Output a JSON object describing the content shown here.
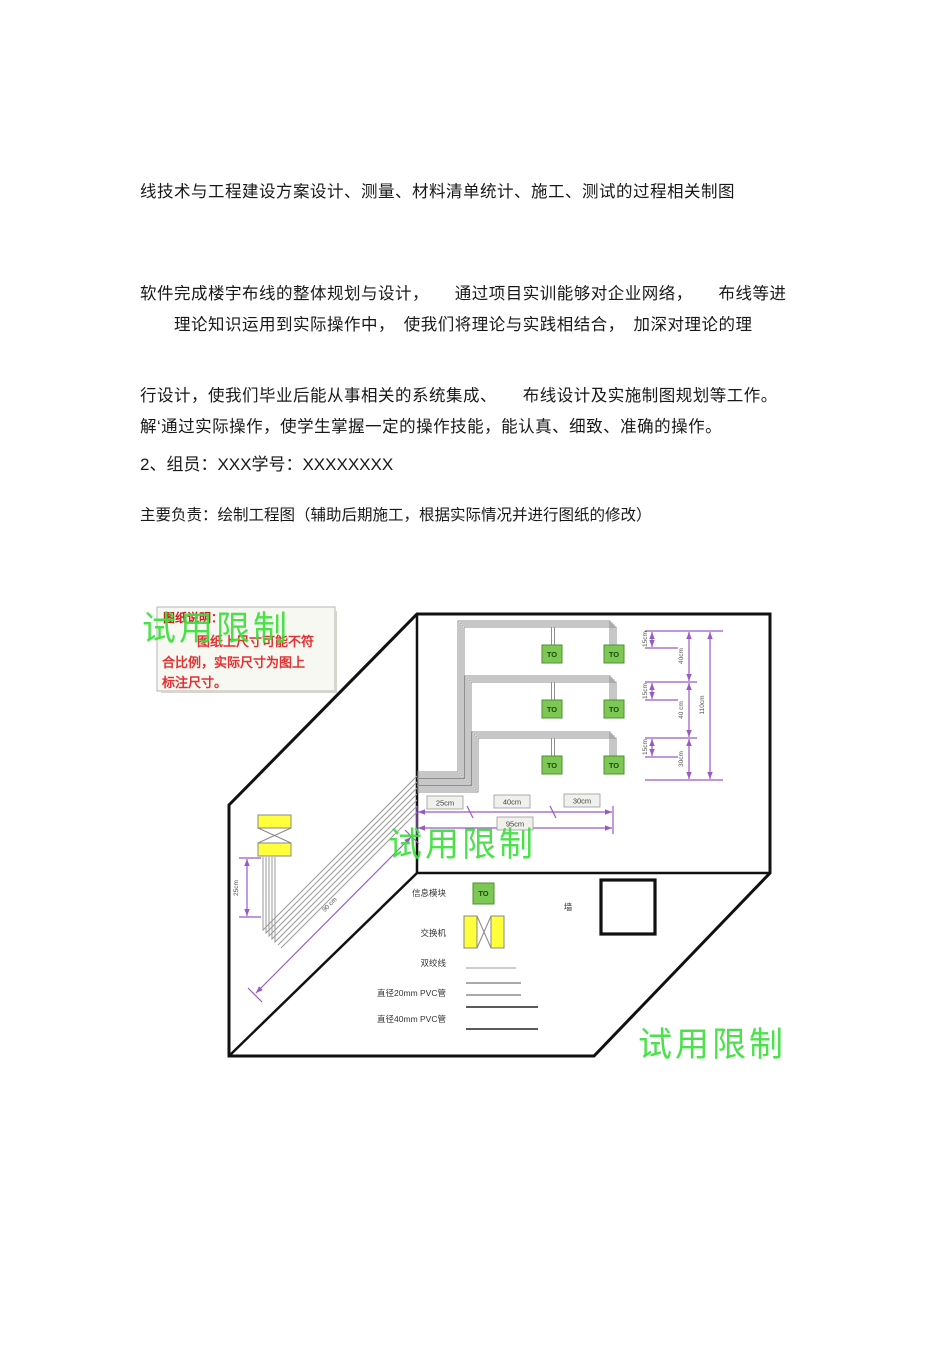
{
  "document": {
    "paragraph1_lines": [
      "线技术与工程建设方案设计、测量、材料清单统计、施工、测试的过程相关制图",
      "软件完成楼宇布线的整体规划与设计，　　通过项目实训能够对企业网络，　　布线等进",
      "行设计，使我们毕业后能从事相关的系统集成、　　布线设计及实施制图规划等工作。"
    ],
    "paragraph2_lines": [
      "　　理论知识运用到实际操作中，　使我们将理论与实践相结合，　加深对理论的理",
      "解‘通过实际操作，使学生掌握一定的操作技能，能认真、细致、准确的操作。"
    ],
    "member_line": "2、组员：XXX学号：XXXXXXXX",
    "duty_line": "主要负责：绘制工程图（辅助后期施工，根据实际情况并进行图纸的修改）"
  },
  "diagram": {
    "watermark": "试用限制",
    "note": {
      "title": "图纸说明：",
      "lines": [
        "图纸上尺寸可能不符",
        "合比例，实际尺寸为图上",
        "标注尺寸。"
      ]
    },
    "to_label": "TO",
    "dims": {
      "small": "15cm",
      "right_segments": [
        "40cm",
        "40 cm",
        "30cm"
      ],
      "right_total": "110cm",
      "bottom_segments": [
        "25cm",
        "40cm",
        "30cm"
      ],
      "bottom_total": "95cm",
      "left_vertical": "25cm",
      "diagonal": "90 cm"
    },
    "legend": {
      "info_module": "信息模块",
      "switch": "交换机",
      "twisted_pair": "双绞线",
      "pvc20": "直径20mm  PVC管",
      "pvc40": "直径40mm PVC管",
      "wall": "墙"
    },
    "colors": {
      "module_green": "#7dc855",
      "switch_yellow": "#ffff3c",
      "dimension_purple": "#9b59c8",
      "watermark_green": "#3bdf3b",
      "note_red": "#cc2222",
      "cable_gray": "#8f8f8f"
    }
  }
}
